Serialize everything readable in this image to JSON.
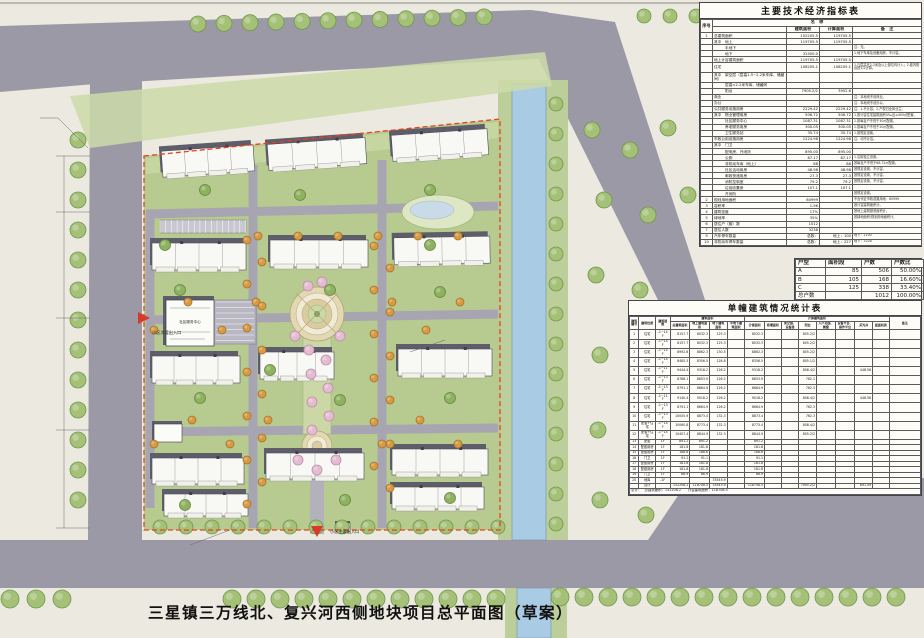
{
  "title": {
    "text": "三星镇三万线北、复兴河西侧地块项目总平面图（草案）"
  },
  "tech_table": {
    "title": "主要技术经济指标表",
    "name_header": "名　称",
    "columns": [
      "序号",
      "名　称",
      "建筑面积",
      "计算面积",
      "备　注"
    ],
    "rows": [
      [
        "1",
        "总建筑面积",
        "152205.5",
        "119705.5",
        ""
      ],
      [
        "",
        "其中　地上",
        "119705.5",
        "119705.5",
        ""
      ],
      [
        "",
        "　　　半地下",
        "",
        "",
        "注：无。"
      ],
      [
        "",
        "　　　地下",
        "32500.0",
        "",
        "1.地下车库及设备用房，不计容。"
      ],
      [
        "",
        "地上计容建筑面积",
        "119705.5",
        "119705.5",
        ""
      ],
      [
        "",
        "住宅",
        "108205.1",
        "108205.1",
        "1.凡层高在2.2米及以上部位均计入；2.套内阳台按1/2计算。"
      ],
      [
        "",
        "其中　架空层（层高1.5~2.2米车库、储藏间）",
        "",
        "",
        ""
      ],
      [
        "",
        "　　　层高<2.2米车库、储藏间",
        "",
        "",
        ""
      ],
      [
        "",
        "　　　阳台",
        "7905.2/2",
        "3952.6",
        ""
      ],
      [
        "",
        "商业",
        "",
        "",
        "注：本地块不设商业。"
      ],
      [
        "",
        "办公",
        "",
        "",
        "注：本地块不设办公。"
      ],
      [
        "",
        "公共服务设施用房",
        "2229.42",
        "2229.42",
        "注：1.不计容；2.产权归全体业主。"
      ],
      [
        "",
        "其中　物业管理用房",
        "506.72",
        "506.72",
        "1.按计容住宅建筑面积4‰且≥400㎡配置。"
      ],
      [
        "",
        "　　　社区服务中心",
        "1087.31",
        "1087.31",
        "1.按每百户不低于30㎡配置。"
      ],
      [
        "",
        "　　　养老服务用房",
        "300.05",
        "300.05",
        "1.按每百户不低于20㎡配置。"
      ],
      [
        "",
        "　　　卫生服务站",
        "35.74",
        "35.74",
        "1.按规定设置。"
      ],
      [
        "",
        "市政公用设施用房",
        "1224.98",
        "1224.98",
        "注：均不计容。"
      ],
      [
        "",
        "其中　门卫",
        "",
        "",
        ""
      ],
      [
        "",
        "　　　配电房、开闭所",
        "895.00",
        "895.00",
        ""
      ],
      [
        "",
        "　　　公厕",
        "87.17",
        "87.17",
        "1.沿街独立设置。"
      ],
      [
        "",
        "　　　非机动车库（地上）",
        "88",
        "88",
        "按每百户不低于68.72㎡配置。"
      ],
      [
        "",
        "　　　社区活动用房",
        "48.98",
        "48.98",
        "按规定设置，不计容。"
      ],
      [
        "",
        "　　　邮政快递用房",
        "27.3",
        "27.3",
        "按规定设置，不计容。"
      ],
      [
        "",
        "　　　消防控制室",
        "79.2",
        "79.2",
        "按规定设置，不计容。"
      ],
      [
        "",
        "　　　垃圾收集房",
        "107.1",
        "107.1",
        ""
      ],
      [
        "",
        "　　　开闭所",
        "",
        "",
        "按规定设置。"
      ],
      [
        "2",
        "规划用地面积",
        "60999",
        "",
        "不含代征市政道路用地：60999"
      ],
      [
        "3",
        "容积率",
        "1.96",
        "",
        "按计容建筑面积计。"
      ],
      [
        "4",
        "建筑密度",
        "17%",
        "",
        "按地上建筑基底面积计。"
      ],
      [
        "5",
        "绿地率",
        "35%",
        "",
        "按绿地面积/规划用地面积计。"
      ],
      [
        "6",
        "居住户（套）数",
        "1012",
        "",
        ""
      ],
      [
        "7",
        "居住人数",
        "3238",
        "",
        ""
      ],
      [
        "9",
        "汽车停车数量",
        "总数：",
        "地上：100",
        "地下：1100"
      ],
      [
        "10",
        "非机动车停车数量",
        "总数：",
        "地上：227",
        "地下：3228"
      ]
    ]
  },
  "unit_table": {
    "columns": [
      "户型",
      "面积段",
      "户数",
      "户数比"
    ],
    "rows": [
      [
        "A",
        "85",
        "506",
        "50.00%"
      ],
      [
        "B",
        "105",
        "168",
        "16.60%"
      ],
      [
        "C",
        "125",
        "338",
        "33.40%"
      ],
      [
        "总户数",
        "",
        "1012",
        "100.00%"
      ]
    ]
  },
  "building_table": {
    "title": "单幢建筑情况统计表",
    "top_headers": [
      "建筑编号",
      "建筑性质",
      "建筑层数",
      "建筑面积",
      "计算建筑面积",
      "备注"
    ],
    "sub_headers": [
      "总建筑面积",
      "地上建筑面积",
      "地下建筑面积",
      "半地下建筑面积",
      "计容面积",
      "核增面积",
      "架空层、设备层",
      "阳台",
      "入户花园、飘窗",
      "设备平台、操作平台",
      "采光井",
      "屋面机房"
    ],
    "rows": [
      [
        "1",
        "住宅",
        "-1~14F",
        "8157.7",
        "8032.3",
        "125.3",
        "",
        "8032.3",
        "",
        "",
        "805.2/2",
        "",
        "",
        "",
        "",
        ""
      ],
      [
        "2",
        "住宅",
        "-1~14F",
        "8157.7",
        "8032.3",
        "125.3",
        "",
        "8032.3",
        "",
        "",
        "805.2/2",
        "",
        "",
        "",
        "",
        ""
      ],
      [
        "3",
        "住宅",
        "-1~14F",
        "8992.8",
        "8862.3",
        "130.5",
        "",
        "8862.3",
        "",
        "",
        "805.2/2",
        "",
        "",
        "",
        "",
        ""
      ],
      [
        "4",
        "住宅",
        "-1~14F",
        "8485.3",
        "8356.5",
        "128.8",
        "",
        "8356.5",
        "",
        "",
        "805.1/2",
        "",
        "",
        "",
        "",
        ""
      ],
      [
        "5",
        "住宅",
        "-1~11F",
        "9444.4",
        "9318.2",
        "126.2",
        "",
        "9318.2",
        "",
        "",
        "808.4/2",
        "",
        "",
        "448.56",
        "",
        ""
      ],
      [
        "6",
        "住宅",
        "-1~13F",
        "8786.1",
        "8653.9",
        "126.2",
        "",
        "8653.9",
        "",
        "",
        "762.1",
        "",
        "",
        "",
        "",
        ""
      ],
      [
        "7",
        "住宅",
        "-1~13F",
        "8791.1",
        "8664.9",
        "126.2",
        "",
        "8664.9",
        "",
        "",
        "762.3",
        "",
        "",
        "",
        "",
        ""
      ],
      [
        "8",
        "住宅",
        "-1~11F",
        "9140.4",
        "9018.2",
        "126.2",
        "",
        "9018.2",
        "",
        "",
        "808.4/2",
        "",
        "",
        "448.56",
        "",
        ""
      ],
      [
        "9",
        "住宅",
        "-1~13F",
        "8791.1",
        "8664.9",
        "126.2",
        "",
        "8664.9",
        "",
        "",
        "762.3",
        "",
        "",
        "",
        "",
        ""
      ],
      [
        "10",
        "住宅",
        "-1~13F",
        "10005.9",
        "8873.4",
        "132.3",
        "",
        "8873.4",
        "",
        "",
        "762.3",
        "",
        "",
        "",
        "",
        ""
      ],
      [
        "11",
        "配套+住宅",
        "-1~14F",
        "10060.8",
        "8773.4",
        "132.3",
        "",
        "8773.4",
        "",
        "",
        "808.4/2",
        "",
        "",
        "",
        "",
        ""
      ],
      [
        "12",
        "配套+住宅",
        "-1~14F",
        "10407.4",
        "8844.9",
        "132.3",
        "",
        "8844.9",
        "",
        "",
        "805.2/2",
        "",
        "",
        "",
        "",
        ""
      ],
      [
        "13",
        "配套",
        "1F",
        "891.2",
        "891.2",
        "",
        "",
        "891.2",
        "",
        "",
        "",
        "",
        "",
        "",
        "",
        ""
      ],
      [
        "14",
        "配套用房",
        "1F",
        "181.8",
        "181.8",
        "",
        "",
        "181.8",
        "",
        "",
        "",
        "",
        "",
        "",
        "",
        ""
      ],
      [
        "15",
        "配套用房",
        "1F",
        "188.6",
        "188.6",
        "",
        "",
        "188.6",
        "",
        "",
        "",
        "",
        "",
        "",
        "",
        ""
      ],
      [
        "16",
        "门卫",
        "1F",
        "91.1",
        "91.1",
        "",
        "",
        "91.1",
        "",
        "",
        "",
        "",
        "",
        "",
        "",
        ""
      ],
      [
        "17",
        "配套用房",
        "1F",
        "181.8",
        "181.8",
        "",
        "",
        "181.8",
        "",
        "",
        "",
        "",
        "",
        "",
        "",
        ""
      ],
      [
        "18",
        "配套用房",
        "1F",
        "181.8",
        "181.8",
        "",
        "",
        "181.8",
        "",
        "",
        "",
        "",
        "",
        "",
        "",
        ""
      ],
      [
        "19",
        "门卫",
        "1F",
        "86.9",
        "86.9",
        "",
        "",
        "86.9",
        "",
        "",
        "",
        "",
        "",
        "",
        "",
        ""
      ],
      [
        "20",
        "地库",
        "-1F",
        "",
        "",
        "33545.9",
        "",
        "",
        "",
        "",
        "",
        "",
        "",
        "",
        "",
        ""
      ],
      [
        "",
        "合计",
        "",
        "152208.2",
        "118708.5",
        "33545.9",
        "",
        "118708.5",
        "",
        "",
        "7905.2/2",
        "",
        "",
        "891.09",
        "",
        ""
      ]
    ],
    "footer": "总计：　总建筑面积：152208.2　　计容建筑面积：118708.5"
  },
  "plan": {
    "labels": {
      "main_entrance": "小区主要出入口",
      "secondary_entrance": "小区次要出入口",
      "community_center": "社区服务中心"
    }
  },
  "colors": {
    "boundary_red": "#E8401F",
    "road_gray": "#9B99A6",
    "inner_road_gray": "#A7A5B1",
    "river_blue": "#A9CBE3",
    "site_green": "#B7CA90",
    "street_tree_green": "#A5C178",
    "ornamental_orange": "#D69A43",
    "blossom_pink": "#E4BCD1",
    "building_white": "#F8F8F4"
  }
}
